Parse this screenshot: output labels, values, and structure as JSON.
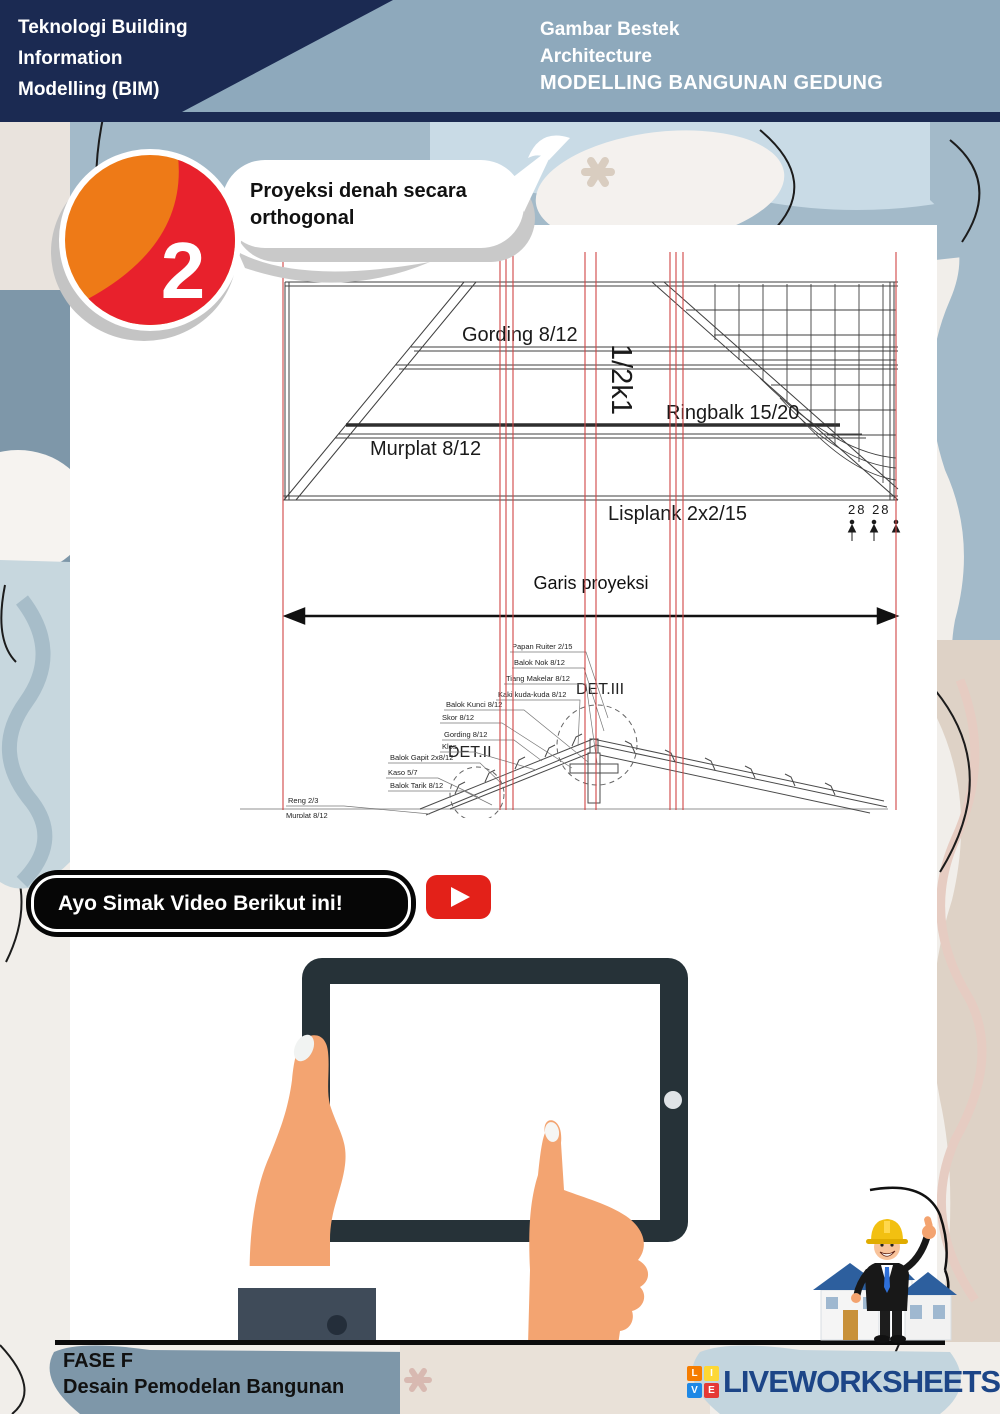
{
  "header": {
    "left_lines": [
      "Teknologi Building",
      "Information",
      "Modelling (BIM)"
    ],
    "right_lines": [
      "Gambar Bestek",
      "Architecture",
      "MODELLING BANGUNAN GEDUNG"
    ]
  },
  "step": {
    "number": "2",
    "bubble_lines": [
      "Proyeksi denah secara",
      "orthogonal"
    ]
  },
  "drawing": {
    "plan_labels": {
      "gording": "Gording 8/12",
      "scale_mark": "1/2k1",
      "ringbalk": "Ringbalk 15/20",
      "murplat": "Murplat 8/12",
      "lisplank": "Lisplank 2x2/15",
      "dimension": "28 28"
    },
    "projection_label": "Garis proyeksi",
    "detail_labels": [
      "DET.II",
      "DET.III"
    ],
    "truss_labels": [
      "Papan Ruiter 2/15",
      "Balok Nok 8/12",
      "Tiang Makelar 8/12",
      "Kaki kuda-kuda 8/12",
      "Balok Kunci 8/12",
      "Skor 8/12",
      "Gording 8/12",
      "Klos",
      "Balok Gapit 2x8/12",
      "Kaso 5/7",
      "Balok Tarik 8/12",
      "Reng 2/3",
      "Murplat 8/12"
    ],
    "colors": {
      "projection_line": "#d04545",
      "drawing_line": "#3f3f3f"
    }
  },
  "video": {
    "button_label": "Ayo Simak Video Berikut ini!",
    "icon": "youtube-play-icon",
    "youtube_red": "#e32119"
  },
  "footer": {
    "phase": "FASE F",
    "subtitle": "Desain Pemodelan Bangunan",
    "brand": "LIVEWORKSHEETS",
    "logo_letters": [
      "L",
      "I",
      "V",
      "E"
    ]
  },
  "colors": {
    "header_navy": "#1b2a52",
    "header_band": "#8ea9bc",
    "step_orange": "#ee7a17",
    "step_red": "#e8212c",
    "tablet_frame": "#263238",
    "skin": "#f3a471",
    "brand_navy": "#1c4587"
  }
}
